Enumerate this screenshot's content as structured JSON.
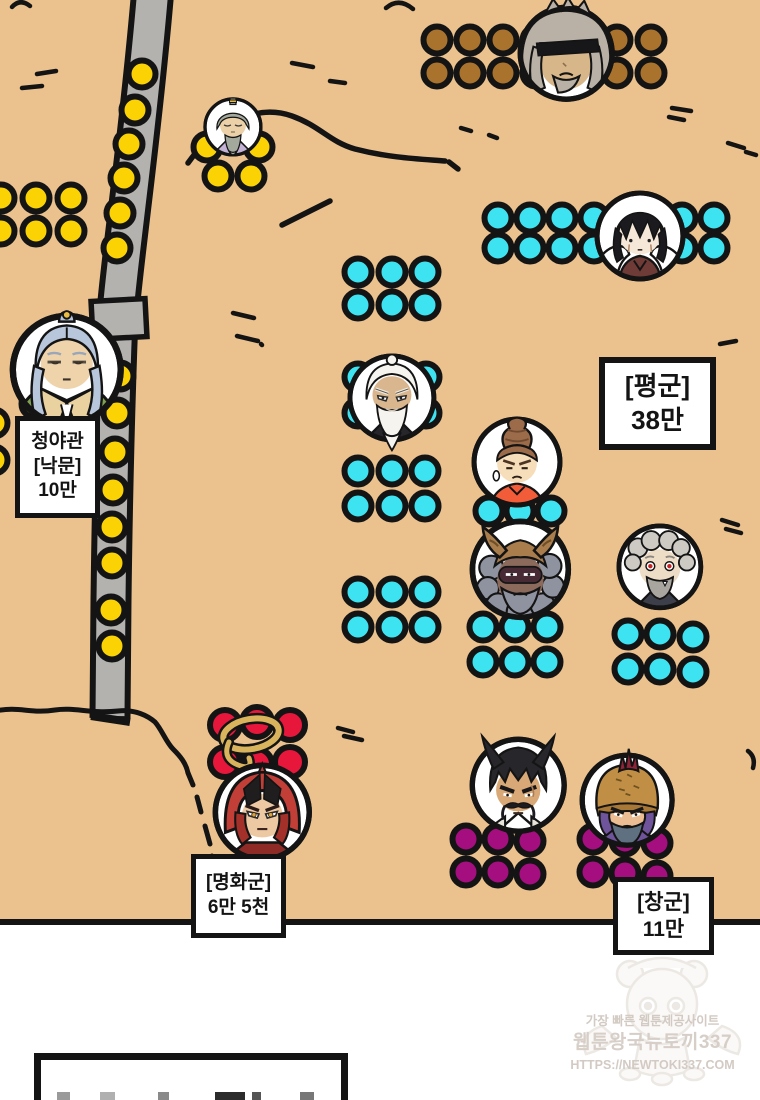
{
  "panel": {
    "background_color": "#ebc28e",
    "type": "webtoon-battle-map"
  },
  "map": {
    "labels": {
      "outpost": {
        "lines": [
          "청야관",
          "[낙문]",
          "10만"
        ]
      },
      "pyeong": {
        "lines": [
          "[평군]",
          "38만"
        ]
      },
      "myeonghwa": {
        "lines": [
          "[명화군]",
          "6만 5천"
        ]
      },
      "chang": {
        "lines": [
          "[창군]",
          "11만"
        ]
      }
    }
  },
  "armies": {
    "yellow": {
      "color": "#fbd304"
    },
    "cyan": {
      "color": "#3ee3f2"
    },
    "brown": {
      "color": "#a9732e"
    },
    "red": {
      "color": "#e7173c"
    },
    "purple": {
      "color": "#a50e7e"
    }
  },
  "dot_clusters": [
    {
      "army": "yellow",
      "name": "yellow-left-top",
      "dots": [
        [
          1,
          198
        ],
        [
          36,
          198
        ],
        [
          71,
          198
        ],
        [
          1,
          231
        ],
        [
          36,
          231
        ],
        [
          71,
          231
        ]
      ]
    },
    {
      "army": "yellow",
      "name": "yellow-elder-guard",
      "dots": [
        [
          207,
          147
        ],
        [
          259,
          147
        ],
        [
          218,
          176
        ],
        [
          251,
          176
        ]
      ]
    },
    {
      "army": "yellow",
      "name": "yellow-road-line",
      "dots": [
        [
          142,
          74
        ],
        [
          135,
          110
        ],
        [
          129,
          144
        ],
        [
          124,
          178
        ],
        [
          120,
          213
        ],
        [
          117,
          248
        ],
        [
          120,
          376
        ],
        [
          117,
          413
        ],
        [
          115,
          452
        ],
        [
          113,
          490
        ],
        [
          112,
          527
        ],
        [
          112,
          563
        ],
        [
          111,
          610
        ],
        [
          112,
          646
        ]
      ]
    },
    {
      "army": "yellow",
      "name": "yellow-left-mid",
      "dots": [
        [
          -6,
          423
        ],
        [
          -6,
          460
        ],
        [
          35,
          404
        ]
      ]
    },
    {
      "army": "brown",
      "name": "brown-north",
      "dots": [
        [
          437,
          40
        ],
        [
          470,
          40
        ],
        [
          503,
          40
        ],
        [
          536,
          40
        ],
        [
          617,
          40
        ],
        [
          651,
          40
        ],
        [
          437,
          73
        ],
        [
          470,
          73
        ],
        [
          503,
          73
        ],
        [
          536,
          73
        ],
        [
          617,
          73
        ],
        [
          651,
          73
        ]
      ]
    },
    {
      "army": "cyan",
      "name": "cyan-row-upper",
      "dots": [
        [
          498,
          218
        ],
        [
          530,
          218
        ],
        [
          562,
          218
        ],
        [
          594,
          218
        ],
        [
          682,
          218
        ],
        [
          714,
          218
        ],
        [
          498,
          248
        ],
        [
          530,
          248
        ],
        [
          562,
          248
        ],
        [
          594,
          248
        ],
        [
          682,
          248
        ],
        [
          714,
          248
        ]
      ]
    },
    {
      "army": "cyan",
      "name": "cyan-a",
      "dots": [
        [
          358,
          272
        ],
        [
          392,
          272
        ],
        [
          425,
          272
        ],
        [
          358,
          305
        ],
        [
          392,
          305
        ],
        [
          425,
          305
        ]
      ]
    },
    {
      "army": "cyan",
      "name": "cyan-b",
      "dots": [
        [
          358,
          377
        ],
        [
          392,
          377
        ],
        [
          426,
          377
        ],
        [
          358,
          413
        ],
        [
          392,
          413
        ],
        [
          426,
          413
        ]
      ]
    },
    {
      "army": "cyan",
      "name": "cyan-c",
      "dots": [
        [
          358,
          471
        ],
        [
          392,
          471
        ],
        [
          425,
          471
        ],
        [
          358,
          506
        ],
        [
          392,
          506
        ],
        [
          425,
          506
        ]
      ]
    },
    {
      "army": "cyan",
      "name": "cyan-d",
      "dots": [
        [
          358,
          592
        ],
        [
          392,
          592
        ],
        [
          425,
          592
        ],
        [
          358,
          627
        ],
        [
          392,
          627
        ],
        [
          425,
          627
        ]
      ]
    },
    {
      "army": "cyan",
      "name": "cyan-e",
      "dots": [
        [
          489,
          511
        ],
        [
          520,
          511
        ],
        [
          551,
          511
        ]
      ]
    },
    {
      "army": "cyan",
      "name": "cyan-f",
      "dots": [
        [
          483,
          627
        ],
        [
          515,
          627
        ],
        [
          547,
          627
        ],
        [
          483,
          662
        ],
        [
          515,
          662
        ],
        [
          547,
          662
        ]
      ]
    },
    {
      "army": "cyan",
      "name": "cyan-g",
      "dots": [
        [
          628,
          634
        ],
        [
          660,
          634
        ],
        [
          693,
          637
        ],
        [
          628,
          669
        ],
        [
          660,
          669
        ],
        [
          693,
          672
        ]
      ]
    },
    {
      "army": "red",
      "name": "red-west",
      "r": 15,
      "dots": [
        [
          225,
          725
        ],
        [
          257,
          722
        ],
        [
          290,
          725
        ],
        [
          225,
          762
        ],
        [
          257,
          764
        ],
        [
          290,
          762
        ]
      ]
    },
    {
      "army": "purple",
      "name": "purple-left",
      "dots": [
        [
          466,
          839
        ],
        [
          498,
          839
        ],
        [
          530,
          841
        ],
        [
          466,
          872
        ],
        [
          498,
          872
        ],
        [
          530,
          874
        ]
      ]
    },
    {
      "army": "purple",
      "name": "purple-right",
      "dots": [
        [
          593,
          839
        ],
        [
          625,
          841
        ],
        [
          657,
          843
        ],
        [
          593,
          872
        ],
        [
          625,
          873
        ],
        [
          657,
          876
        ]
      ]
    }
  ],
  "characters": [
    {
      "id": "elder-topknot",
      "x": 233,
      "y": 127,
      "r": 28
    },
    {
      "id": "blindfold-elder",
      "x": 566,
      "y": 53,
      "r": 46
    },
    {
      "id": "dark-haired-youth",
      "x": 640,
      "y": 236,
      "r": 43
    },
    {
      "id": "white-beard-elder",
      "x": 392,
      "y": 398,
      "r": 42
    },
    {
      "id": "orange-robe-youth",
      "x": 517,
      "y": 462,
      "r": 43
    },
    {
      "id": "horned-demon",
      "x": 520,
      "y": 569,
      "r": 48
    },
    {
      "id": "red-eyed-elder",
      "x": 660,
      "y": 567,
      "r": 41
    },
    {
      "id": "blue-haired-lord",
      "x": 67,
      "y": 370,
      "r": 54
    },
    {
      "id": "red-armor-warrior",
      "x": 262,
      "y": 812,
      "r": 47
    },
    {
      "id": "spiky-hair-general",
      "x": 518,
      "y": 785,
      "r": 46
    },
    {
      "id": "helmet-general",
      "x": 627,
      "y": 800,
      "r": 45
    }
  ],
  "watermark": {
    "lines": [
      "가장 빠른 웹툰제공사이트",
      "웹툰왕국뉴토끼337",
      "HTTPS://NEWTOKI337.COM"
    ]
  }
}
